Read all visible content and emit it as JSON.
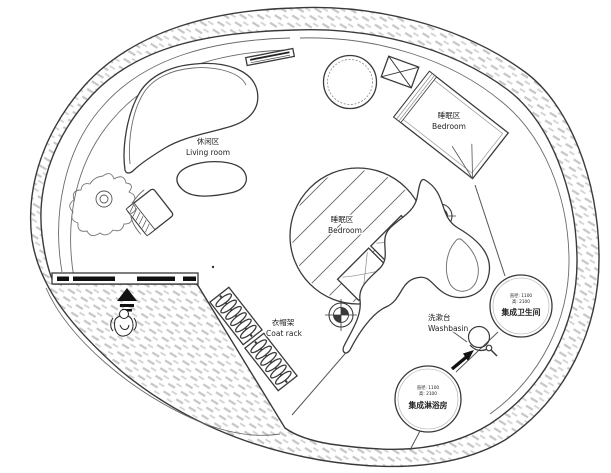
{
  "colors": {
    "background": "#ffffff",
    "line": "#3a3a3a",
    "hatch": "#c6c6c6",
    "ink": "#111111",
    "text": "#222222"
  },
  "labels": {
    "living": {
      "zh": "休闲区",
      "en": "Living room"
    },
    "bedroom_top": {
      "zh": "睡眠区",
      "en": "Bedroom"
    },
    "bedroom_center": {
      "zh": "睡眠区",
      "en": "Bedroom"
    },
    "coat_rack": {
      "zh": "衣帽架",
      "en": "Coat rack"
    },
    "washbasin": {
      "zh": "洗漱台",
      "en": "Washbasin"
    }
  },
  "pods": {
    "toilet": {
      "spec1": "直径: 1100",
      "spec2": "高: 2100",
      "name": "集成卫生间"
    },
    "shower": {
      "spec1": "直径: 1100",
      "spec2": "高: 2100",
      "name": "集成淋浴房"
    }
  }
}
